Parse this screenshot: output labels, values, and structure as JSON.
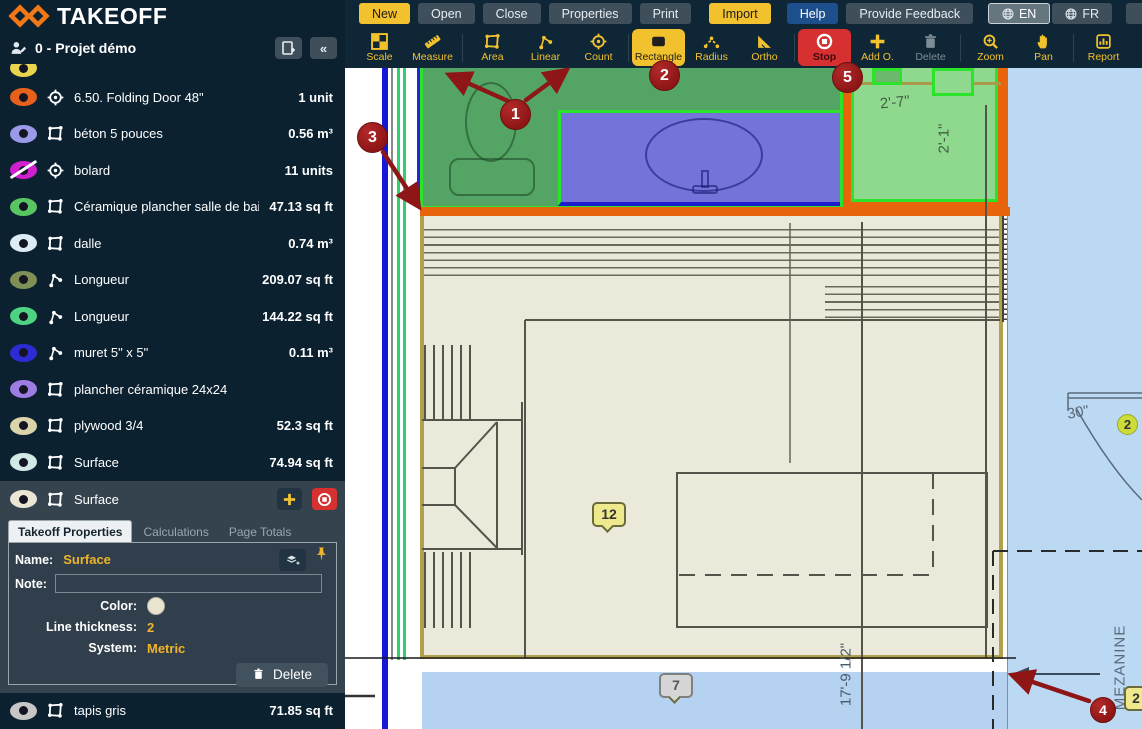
{
  "brand": {
    "logo_text": "TAKEOFF"
  },
  "topbar": {
    "buttons": [
      {
        "label": "New",
        "variant": "yellow"
      },
      {
        "label": "Open",
        "variant": "gray"
      },
      {
        "label": "Close",
        "variant": "gray"
      },
      {
        "label": "Properties",
        "variant": "gray"
      },
      {
        "label": "Print",
        "variant": "gray"
      },
      {
        "label": "Import",
        "variant": "yellow",
        "gap": 18
      },
      {
        "label": "Help",
        "variant": "blue",
        "gap": 16
      },
      {
        "label": "Provide Feedback",
        "variant": "gray"
      }
    ],
    "langs": [
      {
        "label": "EN",
        "active": true
      },
      {
        "label": "FR",
        "active": false
      }
    ]
  },
  "toolbar": {
    "tools": [
      {
        "label": "Scale",
        "icon": "scale-icon"
      },
      {
        "label": "Measure",
        "icon": "measure-icon"
      },
      {
        "sep": true
      },
      {
        "label": "Area",
        "icon": "area-icon"
      },
      {
        "label": "Linear",
        "icon": "linear-icon"
      },
      {
        "label": "Count",
        "icon": "count-icon"
      },
      {
        "sep": true
      },
      {
        "label": "Rectangle",
        "icon": "rectangle-icon",
        "variant": "selected"
      },
      {
        "label": "Radius",
        "icon": "radius-icon"
      },
      {
        "label": "Ortho",
        "icon": "ortho-icon"
      },
      {
        "sep": true
      },
      {
        "label": "Stop",
        "icon": "stop-icon",
        "variant": "danger"
      },
      {
        "label": "Add O.",
        "icon": "add-icon"
      },
      {
        "label": "Delete",
        "icon": "delete-icon",
        "variant": "disabled"
      },
      {
        "sep": true
      },
      {
        "label": "Zoom",
        "icon": "zoom-icon"
      },
      {
        "label": "Pan",
        "icon": "pan-icon"
      },
      {
        "sep": true
      },
      {
        "label": "Report",
        "icon": "report-icon"
      }
    ]
  },
  "sidebar": {
    "project_title": "0 - Projet démo",
    "items": [
      {
        "partial": true,
        "eye": "#e8d44d",
        "type": "",
        "label": "",
        "value": "",
        "hidden": false
      },
      {
        "eye": "#e8611c",
        "type": "count",
        "label": "6.50. Folding Door 48\"",
        "value": "1 unit",
        "hidden": false
      },
      {
        "eye": "#9a9ae8",
        "type": "area",
        "label": "béton 5 pouces",
        "value": "0.56 m³",
        "hidden": false
      },
      {
        "eye": "#cf1fcf",
        "type": "count",
        "label": "bolard",
        "value": "11 units",
        "hidden": true
      },
      {
        "eye": "#58c763",
        "type": "area",
        "label": "Céramique plancher salle de bain",
        "value": "47.13 sq ft",
        "hidden": false
      },
      {
        "eye": "#dcebf4",
        "type": "area",
        "label": "dalle",
        "value": "0.74 m³",
        "hidden": false
      },
      {
        "eye": "#7e9055",
        "type": "linear",
        "label": "Longueur",
        "value": "209.07 sq ft",
        "hidden": false
      },
      {
        "eye": "#4fd382",
        "type": "linear",
        "label": "Longueur",
        "value": "144.22 sq ft",
        "hidden": false
      },
      {
        "eye": "#2c2cd2",
        "type": "linear",
        "label": "muret 5\" x 5\"",
        "value": "0.11 m³",
        "hidden": false
      },
      {
        "eye": "#9d7de2",
        "type": "area",
        "label": "plancher céramique 24x24",
        "value": "",
        "hidden": false
      },
      {
        "eye": "#dbd3aa",
        "type": "area",
        "label": "plywood 3/4",
        "value": "52.3 sq ft",
        "hidden": false
      },
      {
        "eye": "#d2e8e6",
        "type": "area",
        "label": "Surface",
        "value": "74.94 sq ft",
        "hidden": false
      }
    ],
    "selected_item": {
      "eye": "#eae6d3",
      "type": "area",
      "label": "Surface"
    },
    "panel": {
      "tabs": [
        "Takeoff Properties",
        "Calculations",
        "Page Totals"
      ],
      "active_tab": 0,
      "name_label": "Name:",
      "name_value": "Surface",
      "note_label": "Note:",
      "note_value": "",
      "color_label": "Color:",
      "color_value": "#e9e5d0",
      "thickness_label": "Line thickness:",
      "thickness_value": "2",
      "system_label": "System:",
      "system_value": "Metric",
      "delete_label": "Delete"
    },
    "bottom_item": {
      "eye": "#c6c6c6",
      "type": "area",
      "label": "tapis gris",
      "value": "71.85 sq ft",
      "hidden": false
    }
  },
  "canvas": {
    "dims": {
      "d1": "2'-7\"",
      "d2": "2'-1\"",
      "d3": "17'-9 1/2\"",
      "d4": "30\""
    },
    "labels": {
      "mezzanine": "MEZANINE"
    },
    "tags": {
      "t12": "12",
      "t7": "7",
      "t2a": "2",
      "t2b": "2"
    },
    "annotations": {
      "a1": "1",
      "a2": "2",
      "a3": "3",
      "a4": "4",
      "a5": "5"
    },
    "colors": {
      "accent_yellow": "#f2c12e",
      "danger_red": "#d63031",
      "annotation_red": "#8e1616",
      "overlay_green": "#54a565",
      "overlay_blue": "#7473da",
      "overlay_orange": "#e8650d",
      "room_light_green": "#8fd98f",
      "surface_blue": "#bcd9f4",
      "band_blue": "#b5d3f1"
    }
  }
}
